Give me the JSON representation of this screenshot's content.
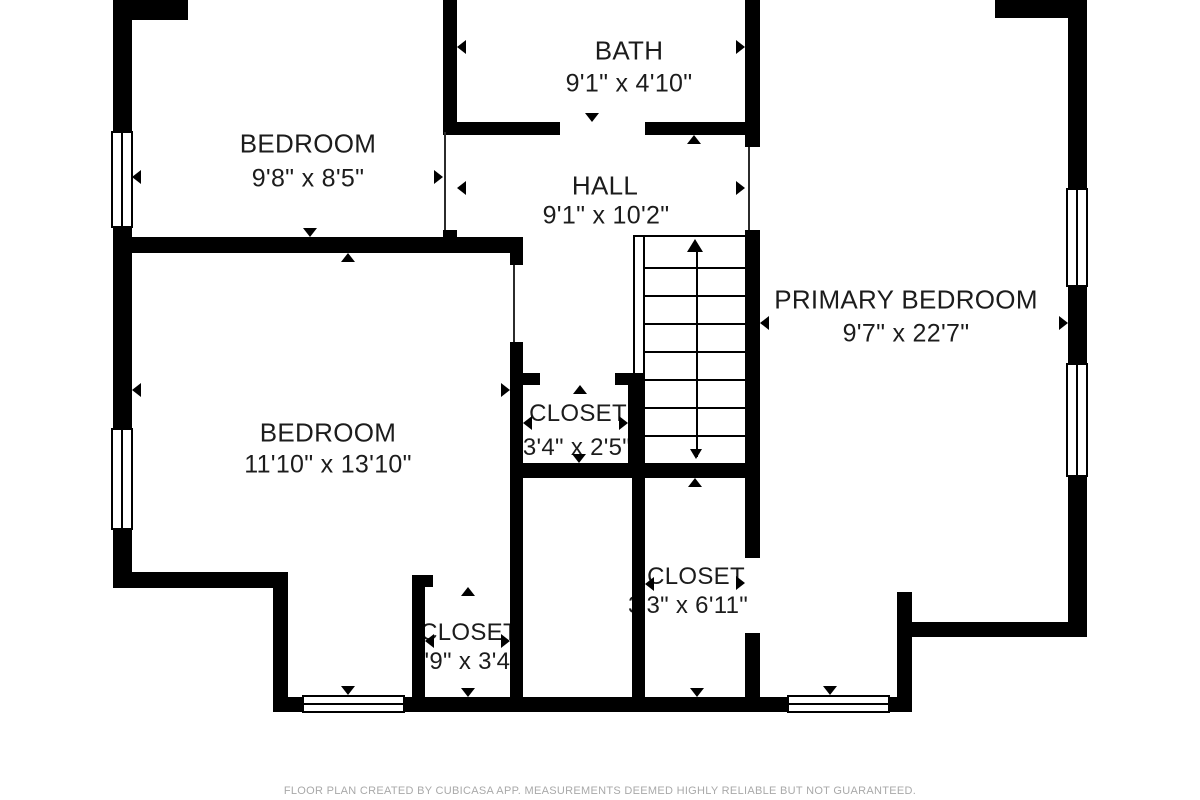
{
  "rooms": {
    "bath": {
      "name": "BATH",
      "dims": "9'1\" x 4'10\""
    },
    "bedroom_top": {
      "name": "BEDROOM",
      "dims": "9'8\" x 8'5\""
    },
    "hall": {
      "name": "HALL",
      "dims": "9'1\" x 10'2\""
    },
    "primary_bedroom": {
      "name": "PRIMARY BEDROOM",
      "dims": "9'7\" x 22'7\""
    },
    "bedroom_left": {
      "name": "BEDROOM",
      "dims": "11'10\" x 13'10\""
    },
    "closet_hall": {
      "name": "CLOSET",
      "dims": "3'4\" x 2'5\""
    },
    "closet_lower": {
      "name": "CLOSET",
      "dims": "3'3\" x 6'11\""
    },
    "closet_entry": {
      "name": "CLOSET",
      "dims": "2'9\" x 3'4\""
    }
  },
  "footer": {
    "disclaimer": "FLOOR PLAN CREATED BY CUBICASA APP. MEASUREMENTS DEEMED HIGHLY RELIABLE BUT NOT GUARANTEED."
  },
  "colors": {
    "wall": "#000000",
    "background": "#ffffff",
    "label": "#1c1c1c",
    "footer_text": "#a9a9a9"
  }
}
